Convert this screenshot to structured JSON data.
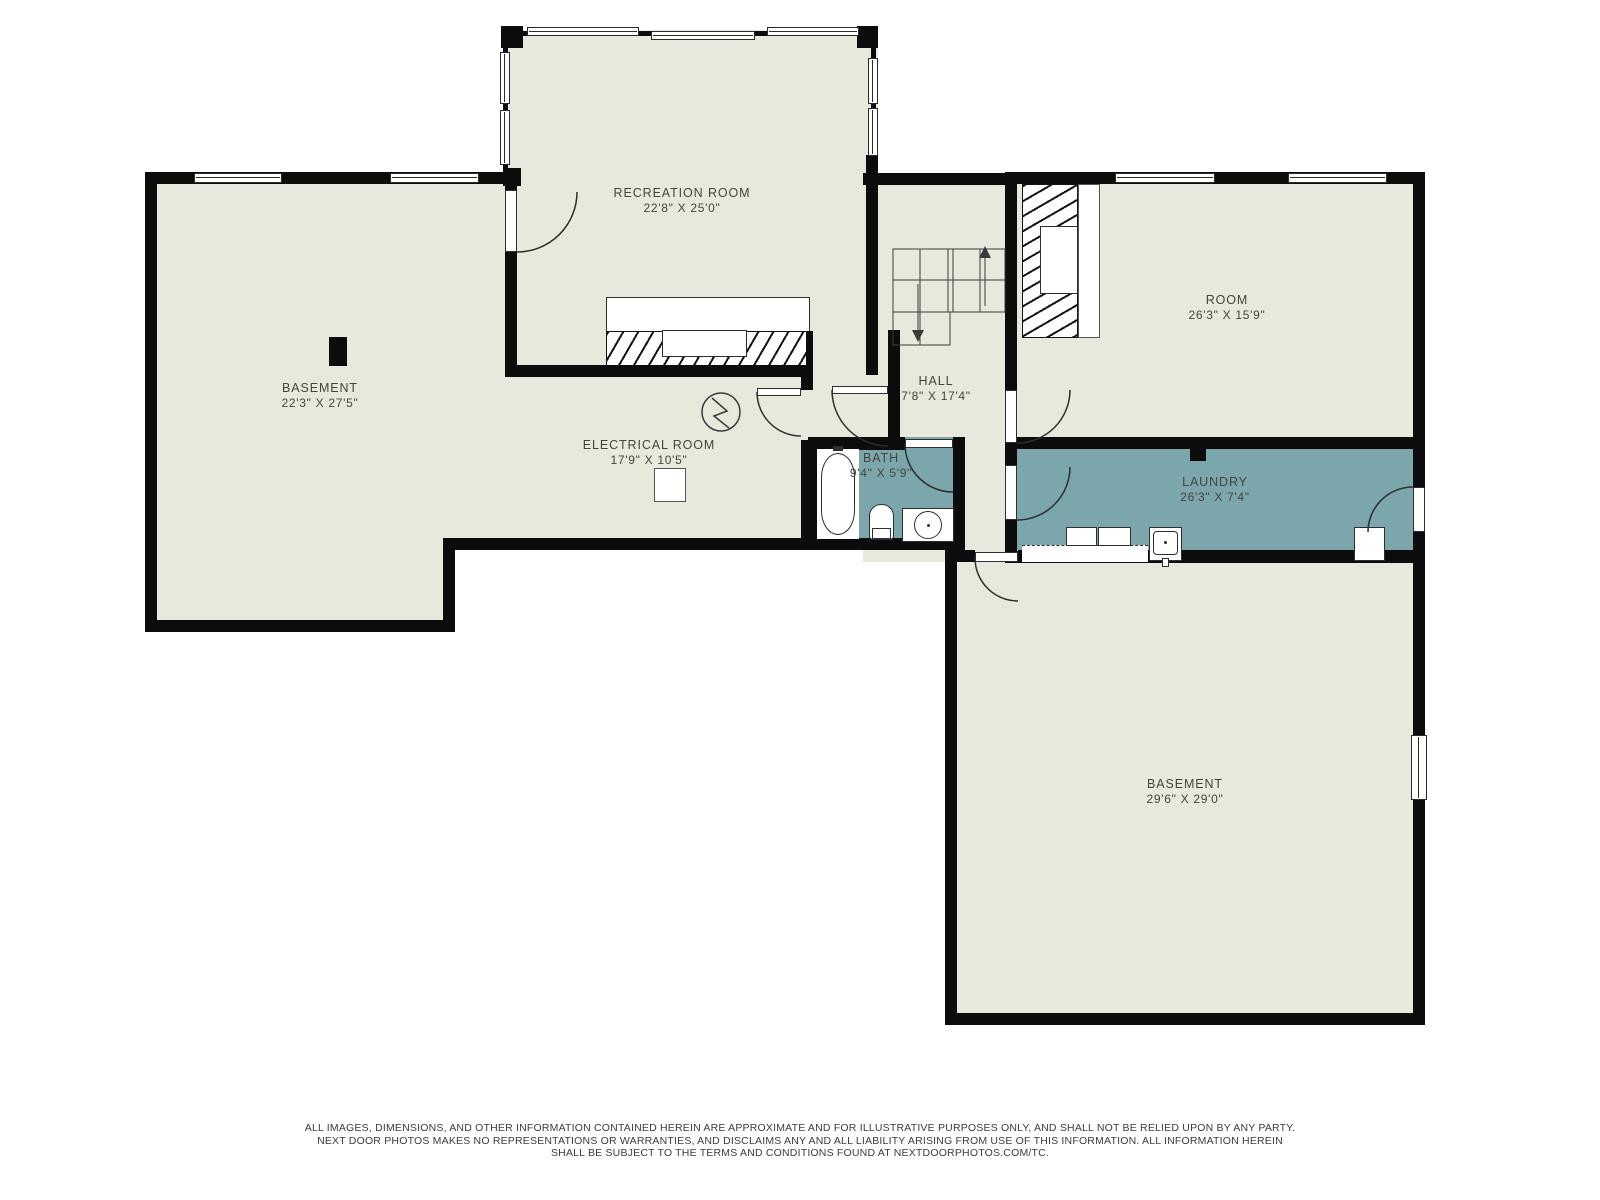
{
  "plan": {
    "title": "Basement floor plan",
    "colors": {
      "wall": "#0c0c0c",
      "floor": "#e9e8dd",
      "wet_room": "#7ba6ac",
      "label_text": "#45453d"
    },
    "rooms": [
      {
        "id": "recreation-room",
        "name": "RECREATION ROOM",
        "dims": "22'8\" X 25'0\"",
        "x": 682,
        "y": 186
      },
      {
        "id": "basement-upper",
        "name": "BASEMENT",
        "dims": "22'3\" X 27'5\"",
        "x": 320,
        "y": 381
      },
      {
        "id": "electrical-room",
        "name": "ELECTRICAL ROOM",
        "dims": "17'9\" X 10'5\"",
        "x": 649,
        "y": 438
      },
      {
        "id": "hall",
        "name": "HALL",
        "dims": "7'8\" X 17'4\"",
        "x": 936,
        "y": 374
      },
      {
        "id": "bath",
        "name": "BATH",
        "dims": "9'4\" X 5'9\"",
        "x": 881,
        "y": 451
      },
      {
        "id": "room",
        "name": "ROOM",
        "dims": "26'3\" X 15'9\"",
        "x": 1227,
        "y": 293
      },
      {
        "id": "laundry",
        "name": "LAUNDRY",
        "dims": "26'3\" X 7'4\"",
        "x": 1215,
        "y": 475
      },
      {
        "id": "basement-lower",
        "name": "BASEMENT",
        "dims": "29'6\" X 29'0\"",
        "x": 1185,
        "y": 777
      }
    ],
    "stairs": {
      "up_label": "up-arrow",
      "down_label": "down-arrow"
    }
  },
  "footer": {
    "lines": [
      "ALL IMAGES, DIMENSIONS, AND OTHER INFORMATION CONTAINED HEREIN ARE APPROXIMATE AND FOR ILLUSTRATIVE PURPOSES ONLY, AND SHALL NOT BE RELIED UPON BY ANY PARTY.",
      "NEXT DOOR PHOTOS MAKES NO REPRESENTATIONS OR WARRANTIES, AND DISCLAIMS ANY AND ALL LIABILITY ARISING FROM USE OF THIS INFORMATION. ALL INFORMATION HEREIN",
      "SHALL BE SUBJECT TO THE TERMS AND CONDITIONS FOUND AT NEXTDOORPHOTOS.COM/TC."
    ]
  }
}
